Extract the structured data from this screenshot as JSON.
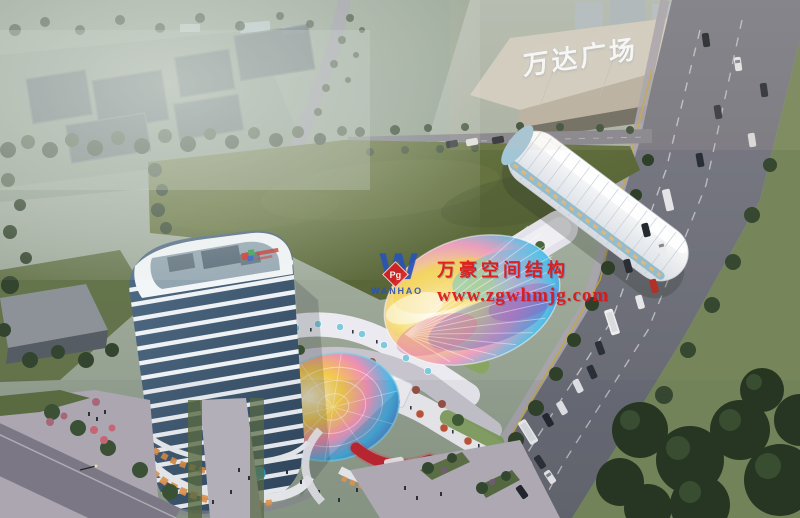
{
  "scene": {
    "description": "Aerial dusk architectural rendering of a mixed-use retail complex: curved white high-rise tower, rainbow membrane canopy, iridescent glass dome and terraced retail podium beside Wanda Plaza mall, a tree-lined boulevard with traffic, and a large green field",
    "width_px": 800,
    "height_px": 518
  },
  "mall": {
    "sign_text": "万达广场"
  },
  "watermark": {
    "company": "万豪空间结构",
    "website": "www.zgwhmjg.com",
    "logo_monogram": "W",
    "logo_text": "WANHAO",
    "logo_badge": "Pg",
    "text_color": "#e01414",
    "logo_blue": "#2853b8",
    "badge_red": "#d42020"
  },
  "palette": {
    "haze": "#a7b3a9",
    "field_green": "#64723d",
    "road_grey": "#71737d",
    "tower_glass": "#3c5166",
    "tower_slab": "#eef2f5",
    "dome_rainbow": [
      "#fdf3cf",
      "#f2c94c",
      "#ef8fb4",
      "#49b9e8",
      "#5a55b8"
    ],
    "led_red": "#c0252e",
    "tree_dark": "#2f3f2e",
    "storefront_warm": "#e89850"
  }
}
